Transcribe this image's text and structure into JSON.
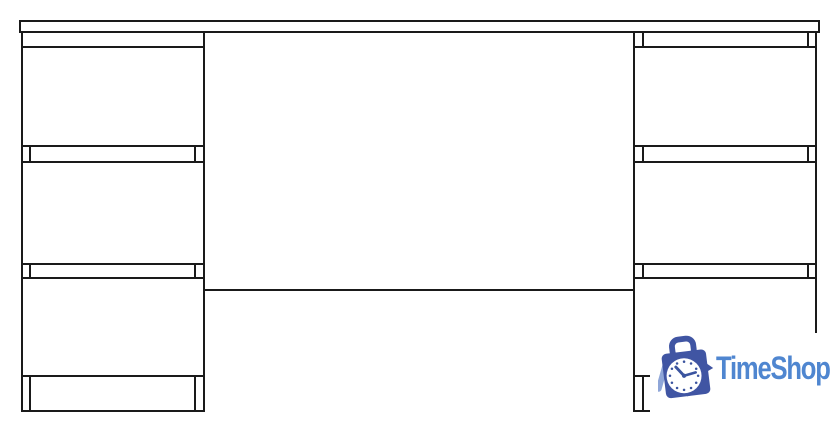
{
  "window": {
    "width": 840,
    "height": 434,
    "background": "#ffffff"
  },
  "product_illustration": {
    "type": "line-drawing",
    "subject": "desk with two three-drawer pedestals and back panel",
    "line_color": "#1a1a1a",
    "fill_color": "#ffffff"
  },
  "logo": {
    "text": "TimeShop",
    "text_color": "#4f86d0",
    "icon": {
      "name": "clock-shopping-bag-icon",
      "bag_color": "#4055a3",
      "accent_color": "#8fa6d8",
      "clock_face_color": "#ffffff",
      "clock_marks_color": "#3b549f"
    }
  }
}
